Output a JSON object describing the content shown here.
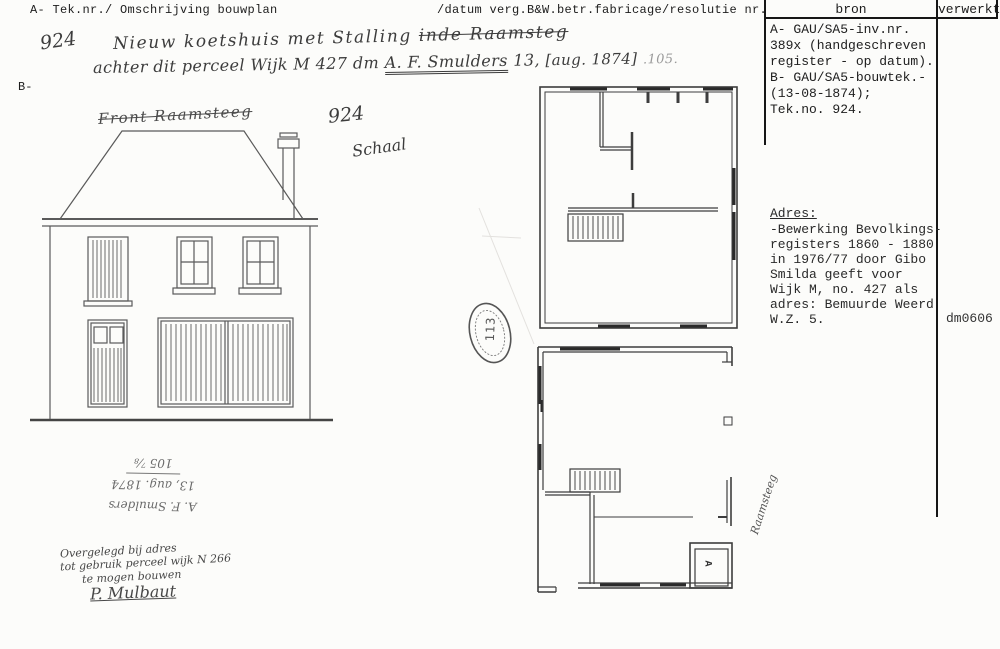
{
  "header": {
    "left": "A- Tek.nr./ Omschrijving bouwplan",
    "middle": "/datum verg.B&W.betr.fabricage/resolutie nr.",
    "col_bron": "bron",
    "col_verwerkt": "verwerkt",
    "b_label": "B-"
  },
  "handwritten": {
    "tek_nr": "924",
    "line1_a": "Nieuw koetshuis met Stalling ",
    "line1_b": "inde Raamsteg",
    "line2_a": "achter dit perceel Wijk M 427 dm ",
    "name": "A. F. Smulders",
    "after_name": " 13,",
    "date_bracket": "[aug. 1874]",
    "number_faint": ".105.",
    "drawing_title": "Front Raamsteeg",
    "drawing_number": "924",
    "scale_label": "Schaal",
    "street_vertical": "Raamsteeg",
    "room_label": "A",
    "stamp_number": "113"
  },
  "bron_box": {
    "lines": [
      "A- GAU/SA5-inv.nr.",
      "389x (handgeschreven",
      "register - op datum).",
      "B- GAU/SA5-bouwtek.-",
      "(13-08-1874);",
      "Tek.no. 924."
    ]
  },
  "adres": {
    "title": "Adres:",
    "lines": [
      "-Bewerking Bevolkings-",
      "registers 1860 - 1880",
      "in 1976/77 door Gibo",
      "Smilda geeft voor",
      "Wijk M, no. 427 als",
      "adres: Bemuurde Weerd",
      "W.Z. 5."
    ]
  },
  "code": "dm0606",
  "notes": {
    "inverted_lines": [
      "A. F. Smulders",
      "13, aug. 1874",
      "105 ⅞"
    ],
    "script_lines": [
      "Overgelegd bij adres",
      "tot gebruik perceel wijk N 266",
      "te mogen bouwen"
    ],
    "signature": "P. Mulbaut"
  }
}
